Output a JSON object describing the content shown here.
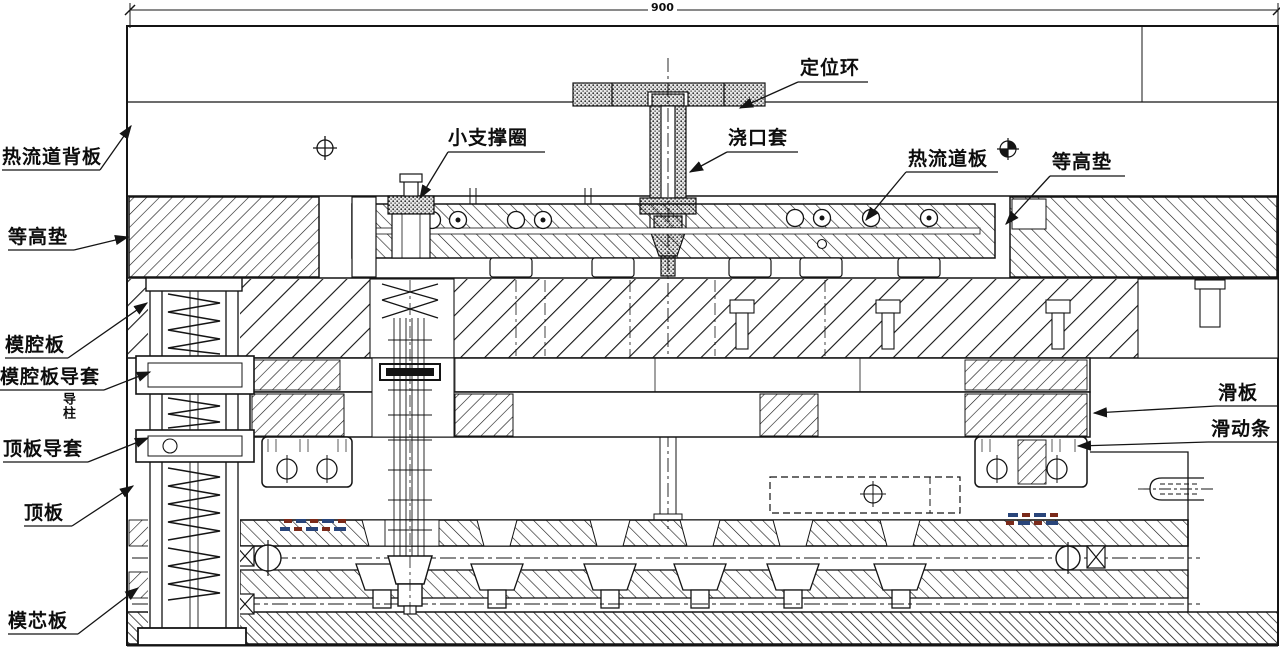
{
  "dimension": {
    "top_width": "900"
  },
  "labels": {
    "hot_runner_back_plate": "热流道背板",
    "spacer_left": "等高垫",
    "cavity_plate": "模腔板",
    "cavity_plate_guide_bushing": "模腔板导套",
    "guide_pillar_vertical": "导柱",
    "top_plate_guide_bushing": "顶板导套",
    "top_plate": "顶板",
    "core_plate": "模芯板",
    "small_support_ring": "小支撑圈",
    "locating_ring": "定位环",
    "sprue_bushing": "浇口套",
    "hot_runner_plate": "热流道板",
    "spacer_right": "等高垫",
    "slide_plate": "滑板",
    "slide_bar": "滑动条"
  },
  "colors": {
    "line": "#141414",
    "background": "#ffffff",
    "micro_annotation_red": "#7a2a1a",
    "micro_annotation_blue": "#29457a"
  }
}
